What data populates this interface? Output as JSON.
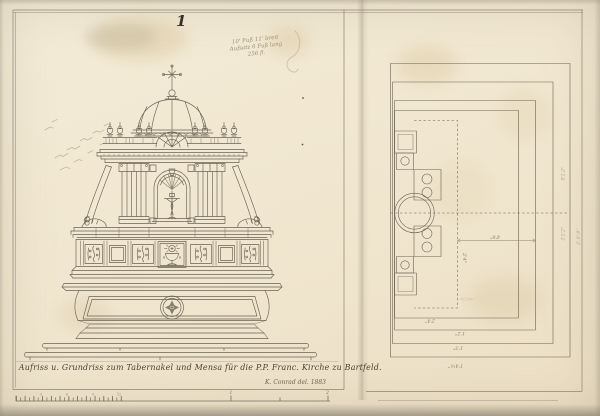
{
  "colors": {
    "paper": "#f1e8d2",
    "ink": "#6a6254",
    "pencil": "#a3997f",
    "caption_ink": "#4b4132",
    "frame": "#8c8475"
  },
  "sheet": {
    "number": "1"
  },
  "pencil_note": {
    "line1": "10' Fuß 11' breit",
    "line2": "Aufsatz 6 Fuß lang",
    "line3": "256 fl."
  },
  "caption": {
    "title": "Aufriss u. Grundriss zum Tabernakel und Mensa für die P.P. Franc. Kirche zu Bartfeld.",
    "signature": "K. Conrad del. 1883"
  },
  "plan": {
    "dim_width": "4'6''",
    "dim_depth": "2'4''",
    "step_labels": [
      "2'4''",
      "1'2''",
      "1'3''",
      "1'4½''"
    ],
    "margin_notes": [
      "8'2.2''",
      "2'2'2''",
      "2'.9'.9''"
    ]
  },
  "scale_bar": {
    "inch_labels": [
      "3",
      "6",
      "9",
      "12"
    ],
    "foot_labels": [
      "1",
      "2"
    ]
  }
}
